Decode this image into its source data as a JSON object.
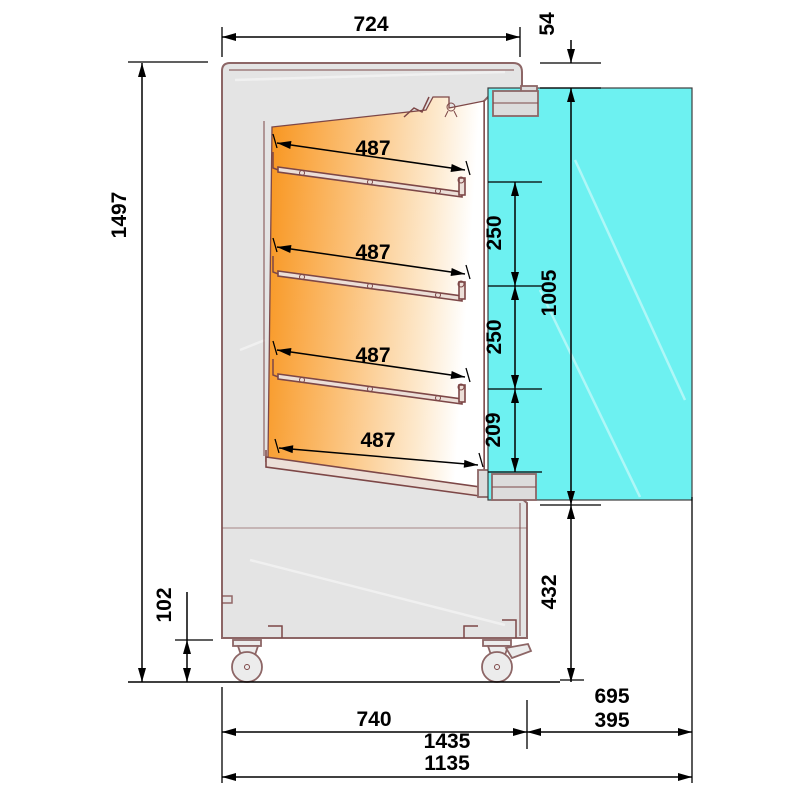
{
  "drawing": {
    "kind": "technical-side-section",
    "subject": "refrigerated-display-cabinet",
    "dims": {
      "total_height": "1497",
      "top_depth": "724",
      "top_offset": "54",
      "shelf1_depth": "487",
      "shelf2_depth": "487",
      "shelf3_depth": "487",
      "shelf4_depth": "487",
      "shelf_gap1": "250",
      "shelf_gap2": "250",
      "shelf_gap3": "209",
      "door_height": "1005",
      "lower_front_height": "432",
      "caster_height": "102",
      "base_depth": "740",
      "door_open_extension": "695",
      "door_panel_depth": "395",
      "total_depth_door_open": "1435",
      "total_depth": "1135"
    },
    "colors": {
      "background": "#ffffff",
      "outline": "#8d6666",
      "interior_line": "#7d4747",
      "body_fill": "#e4e4e4",
      "orange_start": "#f8941c",
      "orange_mid": "#fbbf75",
      "orange_end": "#ffffff",
      "door_fill": "#6df1f1",
      "dimension_color": "#000000"
    }
  }
}
